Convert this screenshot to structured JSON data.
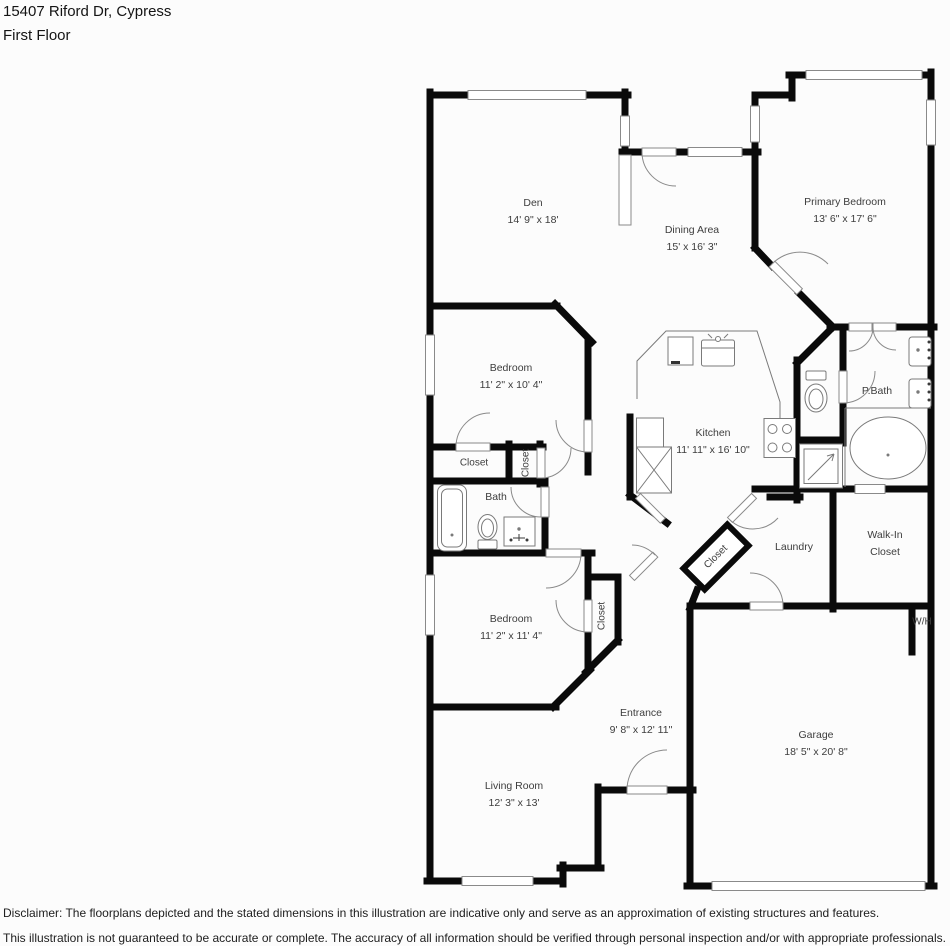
{
  "header": {
    "address": "15407 Riford Dr, Cypress",
    "floor": "First Floor"
  },
  "rooms": [
    {
      "name": "Den",
      "dims": "14' 9\" x 18'"
    },
    {
      "name": "Dining Area",
      "dims": "15' x 16' 3\""
    },
    {
      "name": "Primary Bedroom",
      "dims": "13' 6\" x 17' 6\""
    },
    {
      "name": "Bedroom",
      "dims": "11' 2\" x 10' 4\""
    },
    {
      "name": "Closet"
    },
    {
      "name": "Closet"
    },
    {
      "name": "Bath"
    },
    {
      "name": "Kitchen",
      "dims": "11' 11\" x 16' 10\""
    },
    {
      "name": "P.Bath"
    },
    {
      "name": "Laundry"
    },
    {
      "name": "Walk-In Closet"
    },
    {
      "name": "Closet"
    },
    {
      "name": "Bedroom",
      "dims": "11' 2\" x 11' 4\""
    },
    {
      "name": "Closet"
    },
    {
      "name": "W/H"
    },
    {
      "name": "Entrance",
      "dims": "9' 8\" x 12' 11\""
    },
    {
      "name": "Garage",
      "dims": "18' 5\" x 20' 8\""
    },
    {
      "name": "Living Room",
      "dims": "12' 3\" x 13'"
    }
  ],
  "colors": {
    "wall": "#0a0a0a",
    "thin_line": "#8a8a8a",
    "label_text": "#3d3d3d"
  },
  "disclaimer": {
    "line1": "Disclaimer: The floorplans depicted and the stated dimensions in this illustration are indicative only and serve as an approximation of existing structures and features.",
    "line2": "This illustration is not guaranteed to be accurate or complete. The accuracy of all information should be verified through personal inspection and/or with appropriate professionals."
  }
}
